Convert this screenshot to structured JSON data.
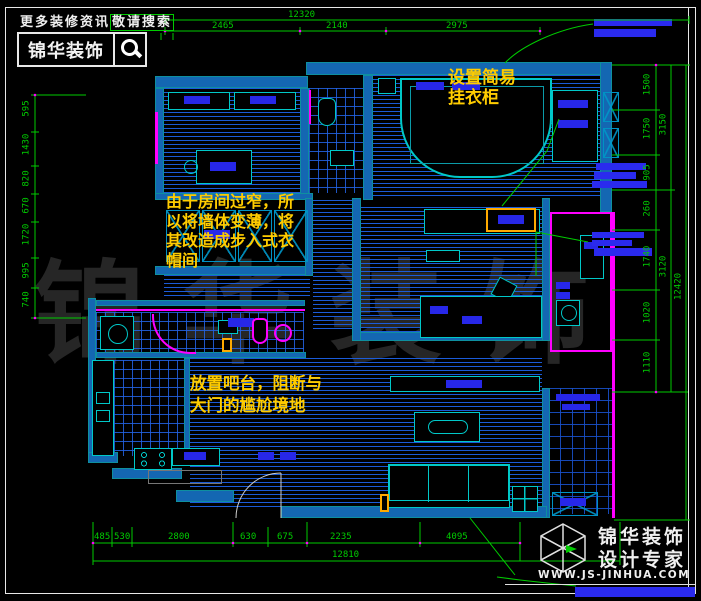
{
  "header": {
    "tagline_a": "更多装修资讯",
    "tagline_b": "敬请搜索",
    "brand": "锦华装饰"
  },
  "watermark": "锦华装饰",
  "notes": {
    "closet_line1": "设置简易",
    "closet_line2": "挂衣柜",
    "wardrobe_line1": "由于房间过窄，所",
    "wardrobe_line2": "以将墙体变薄，将",
    "wardrobe_line3": "其改造成步入式衣",
    "wardrobe_line4": "帽间",
    "bar_line1": "放置吧台，阻断与",
    "bar_line2": "大门的尴尬境地"
  },
  "dims": {
    "top_overall": "12320",
    "top1": "2465",
    "top2": "2140",
    "top3": "2975",
    "bot1": "485",
    "bot2": "530",
    "bot3": "2800",
    "bot4": "630",
    "bot5": "675",
    "bot6": "2235",
    "bot7": "4095",
    "bot_overall": "12810",
    "left1": "595",
    "left2": "1430",
    "left3": "820",
    "left4": "670",
    "left5": "1720",
    "left6": "995",
    "left7": "740",
    "right1": "1500",
    "right2": "1750",
    "right3": "905",
    "right4": "260",
    "right5": "1740",
    "right6": "1020",
    "right7": "1110",
    "rmid1": "3150",
    "rmid2": "3120",
    "right_overall": "12420"
  },
  "logo": {
    "line1": "锦华装饰",
    "line2": "设计专家",
    "url": "WWW.JS-JINHUA.COM"
  },
  "colors": {
    "wall_blue": "#1467b2",
    "hatch_blue": "#1c5fe1",
    "accent_magenta": "#ff00ff",
    "dim_green": "#00cc00",
    "note_yellow": "#ffcc00",
    "label_blue": "#2727e8"
  }
}
